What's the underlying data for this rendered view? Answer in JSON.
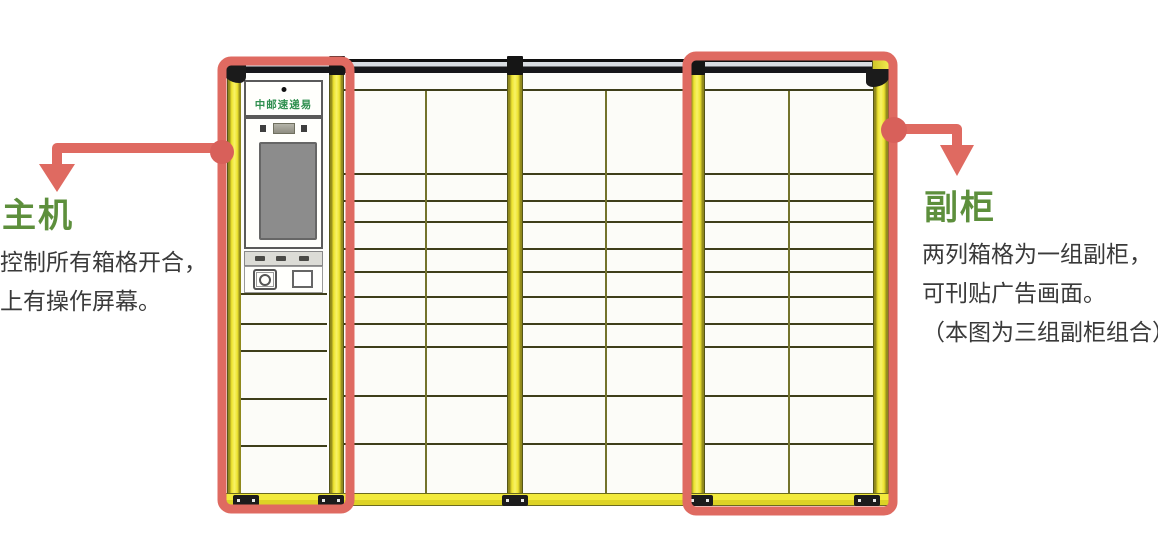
{
  "annotations": {
    "main_unit": {
      "title": "主机",
      "lines": [
        "控制所有箱格开合，",
        "上有操作屏幕。"
      ]
    },
    "aux_cabinet": {
      "title": "副柜",
      "lines": [
        "两列箱格为一组副柜，",
        "可刊贴广告画面。",
        "（本图为三组副柜组合）"
      ]
    }
  },
  "cabinet": {
    "brand": "中邮速递易",
    "aux_group_count": 3,
    "columns_per_group": 2
  },
  "colors": {
    "highlight_red": "#df6a61",
    "connector_dot_red": "#d8605a",
    "label_green": "#5d8f3c",
    "brand_green": "#2f8f4f",
    "frame_yellow": "#eee42f",
    "grid_line": "#3e3e1a",
    "body_text": "#3a3a3a"
  }
}
